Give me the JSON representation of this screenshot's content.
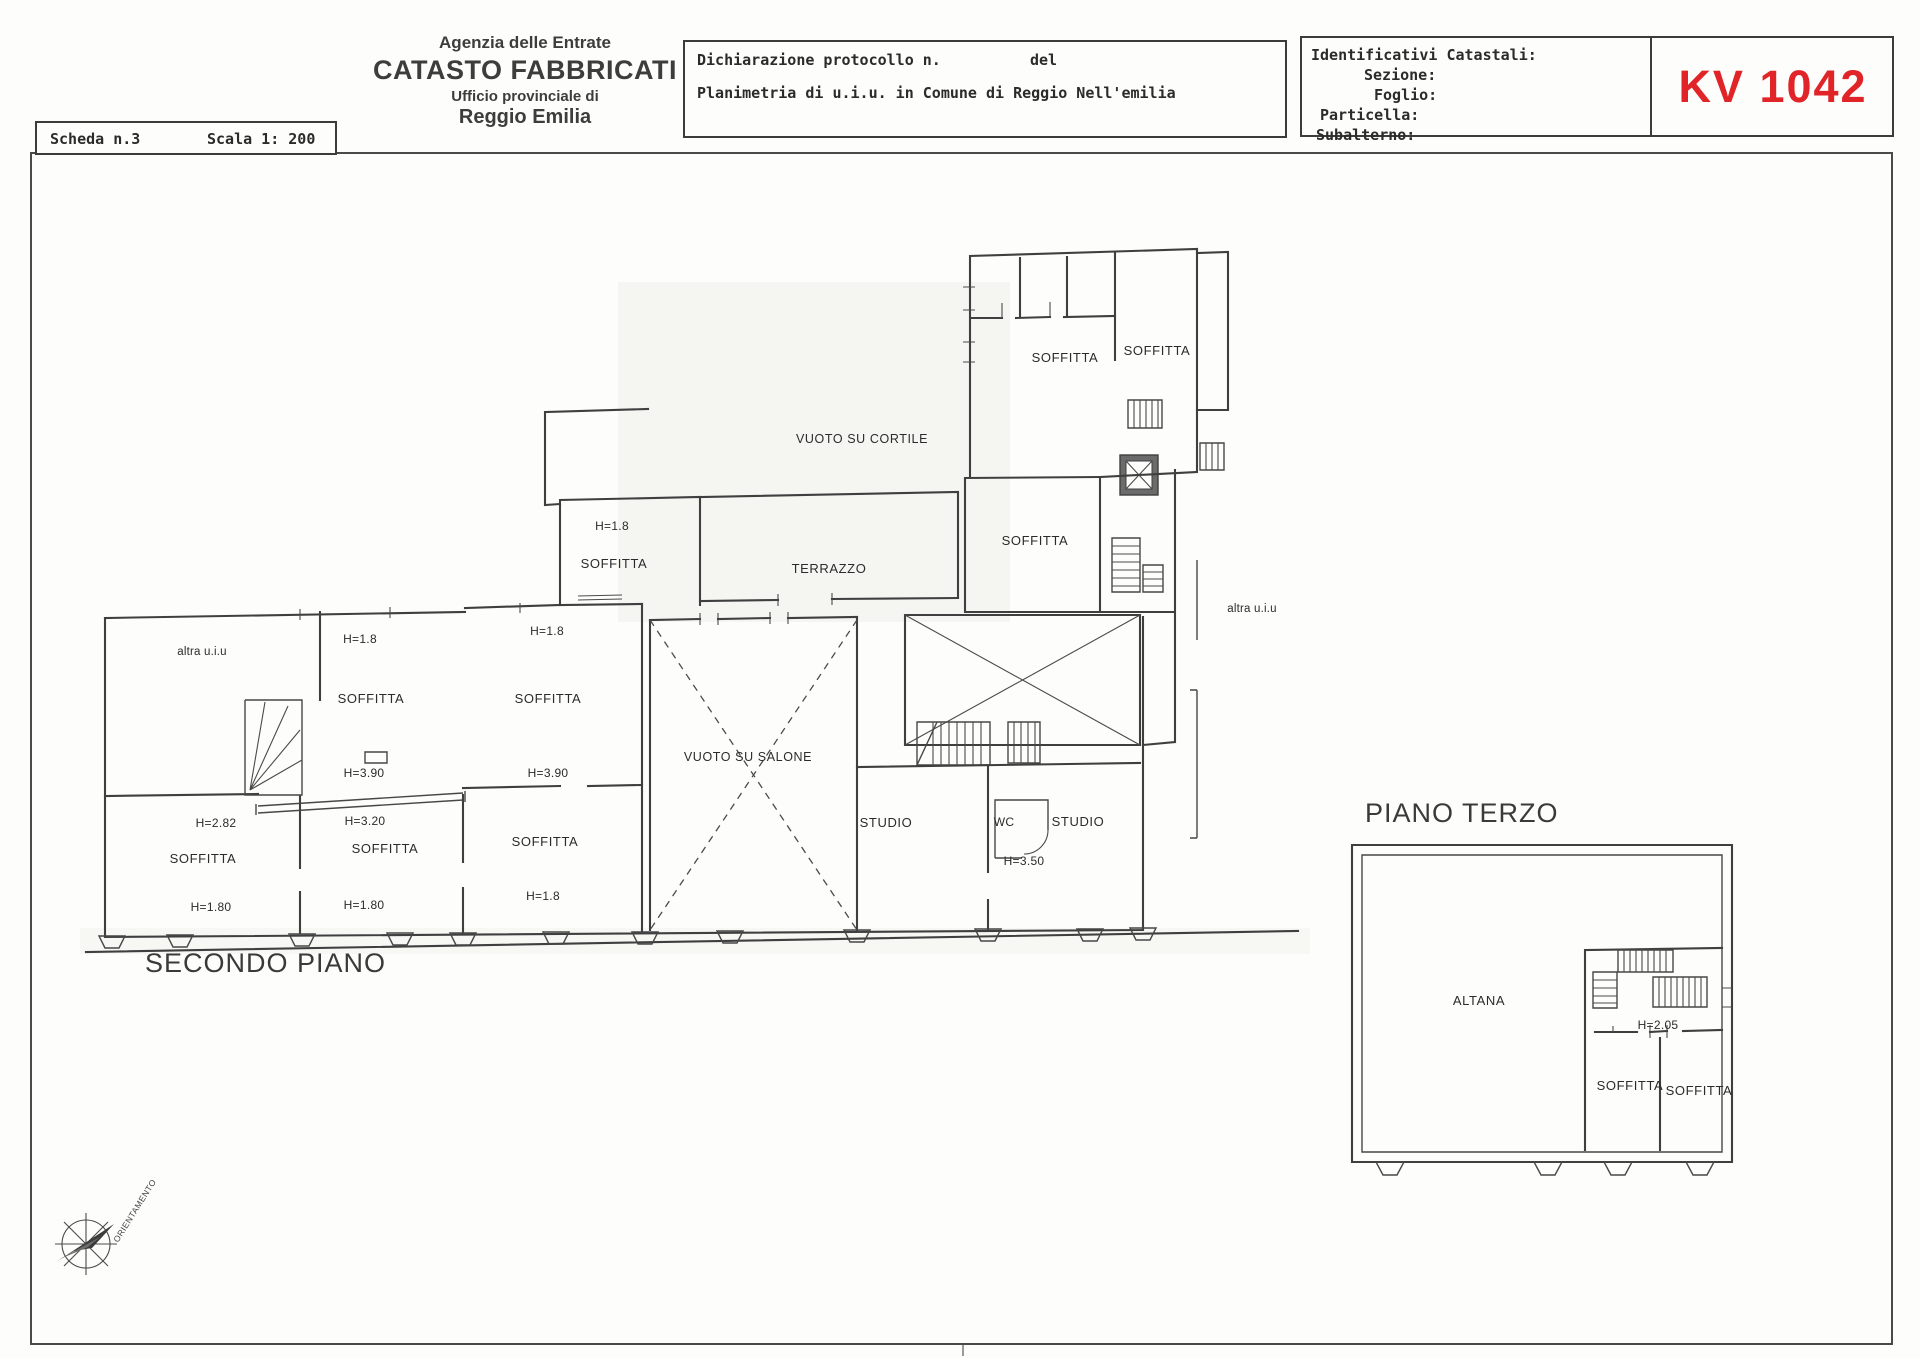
{
  "scheda": {
    "number": "Scheda n.3",
    "scale": "Scala 1: 200"
  },
  "agency": {
    "line1": "Agenzia delle Entrate",
    "line2": "CATASTO FABBRICATI",
    "line3": "Ufficio provinciale di",
    "line4": "Reggio Emilia"
  },
  "declaration": {
    "protocol": "Dichiarazione protocollo n.",
    "del": "del",
    "planimetria": "Planimetria di u.i.u. in Comune di Reggio Nell'emilia"
  },
  "catastali": {
    "title": "Identificativi Catastali:",
    "sezione": "Sezione:",
    "foglio": "Foglio:",
    "particella": "Particella:",
    "subalterno": "Subalterno:",
    "code": "KV 1042"
  },
  "colors": {
    "code_red": "#e02428",
    "ink": "#3f3f3f"
  },
  "plan2": {
    "title": "SECONDO PIANO",
    "labels": [
      "altra u.i.u",
      "H=1.8",
      "SOFFITTA",
      "H=3.90",
      "H=1.8",
      "SOFFITTA",
      "H=3.90",
      "H=1.8",
      "SOFFITTA",
      "TERRAZZO",
      "VUOTO SU CORTILE",
      "SOFFITTA",
      "SOFFITTA",
      "SOFFITTA",
      "altra u.i.u",
      "H=2.82",
      "SOFFITTA",
      "H=1.80",
      "H=3.20",
      "SOFFITTA",
      "H=1.80",
      "SOFFITTA",
      "H=1.8",
      "VUOTO SU SALONE",
      "STUDIO",
      "WC",
      "STUDIO",
      "H=3.50"
    ]
  },
  "plan3": {
    "title": "PIANO TERZO",
    "labels": [
      "ALTANA",
      "H=2.05",
      "SOFFITTA",
      "SOFFITTA"
    ]
  },
  "compass": {
    "label": "ORIENTAMENTO"
  }
}
